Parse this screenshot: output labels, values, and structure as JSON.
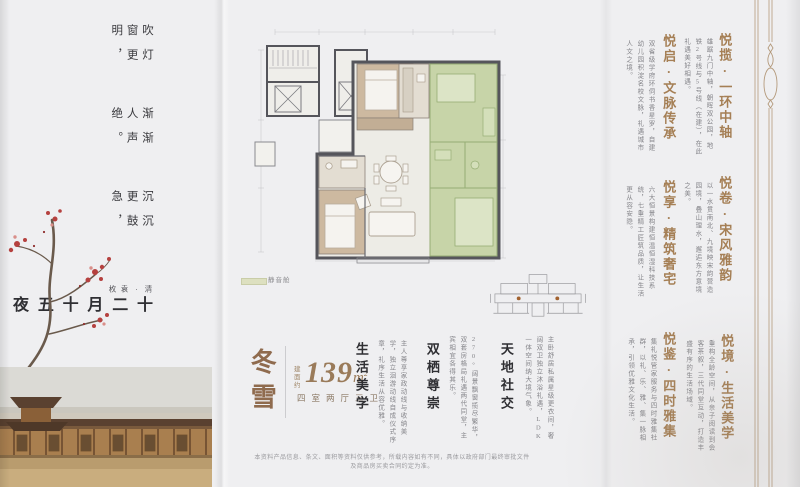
{
  "palette": {
    "accent_brown": "#a57f55",
    "unit_brown": "#8f6b4e",
    "text_dark": "#2f2f33",
    "text_gray": "#85858a",
    "green_room": "#c7d4a8",
    "legend_green": "#dde0c0",
    "wall_gray": "#55555b",
    "keyplan_dot": "#a2622f",
    "blossom_red": "#b5413f"
  },
  "poem": {
    "title": "十二月十五夜",
    "author": "清·袁枚",
    "lines": [
      "沉沉更鼓急，",
      "渐渐人声绝。",
      "吹灯窗更明，",
      "月照一天雪。"
    ]
  },
  "floorplan": {
    "legend_label": "静音舱"
  },
  "unit": {
    "name": "冬雪",
    "area_prefix": "建面约",
    "area_value": "139",
    "area_unit": "m",
    "area_sup": "2",
    "layout": "四室两厅三卫"
  },
  "features": [
    {
      "title": "生活美学",
      "text": "主人尊享家政动线与收纳美学，独立洄游动线自成仪式序章，礼序生活从容优雅。"
    },
    {
      "title": "双栖尊崇",
      "text": "270°阔景飘窗揽尽繁华，双套房格局礼遇两代同堂，主宾相宜各得其乐。"
    },
    {
      "title": "天地社交",
      "text": "主卧舒居私属星级更衣间，奢阔双卫独立沐浴礼遇，LDK一体空间纳大境气象。"
    }
  ],
  "sections_inner": [
    {
      "title": "悦启·文脉传承",
      "text": "双省级学府环伺书香星罗，自建幼儿园积淀名校文脉，礼遇城市人文之境。"
    },
    {
      "title": "悦享·精筑奢宅",
      "text": "六大恒景构建恒温恒湿科技系统，七重精工匠筑品质，让生活更从容安隐。"
    },
    {
      "title": "悦鉴·四时雅集",
      "text": "集礼悦管家服务与四时雅集社群，以礼、乐、雅、集一脉相承，引领优雅文化生活。"
    }
  ],
  "sections_outer": [
    {
      "title": "悦揽·一环中轴",
      "text": "雄踞九门中轴，朝晖双公园，地铁2号线与5号线（在建），在此礼遇美好相遇。"
    },
    {
      "title": "悦卷·宋风雅韵",
      "text": "以一水贯南北、九境映宋韵营造园境，叠山理水，邂逅东方意境之美。"
    },
    {
      "title": "悦境·生活美学",
      "text": "重构全龄空间，从亲子阅读到会客茶叙，三代同堂互动，打造丰盛有序的生活场域。"
    }
  ],
  "disclaimer": "本资料产品信息、条文、面积等资料仅供参考，所载内容如有不同，具体以政府部门最终审批文件及商品房买卖合同约定为准。"
}
